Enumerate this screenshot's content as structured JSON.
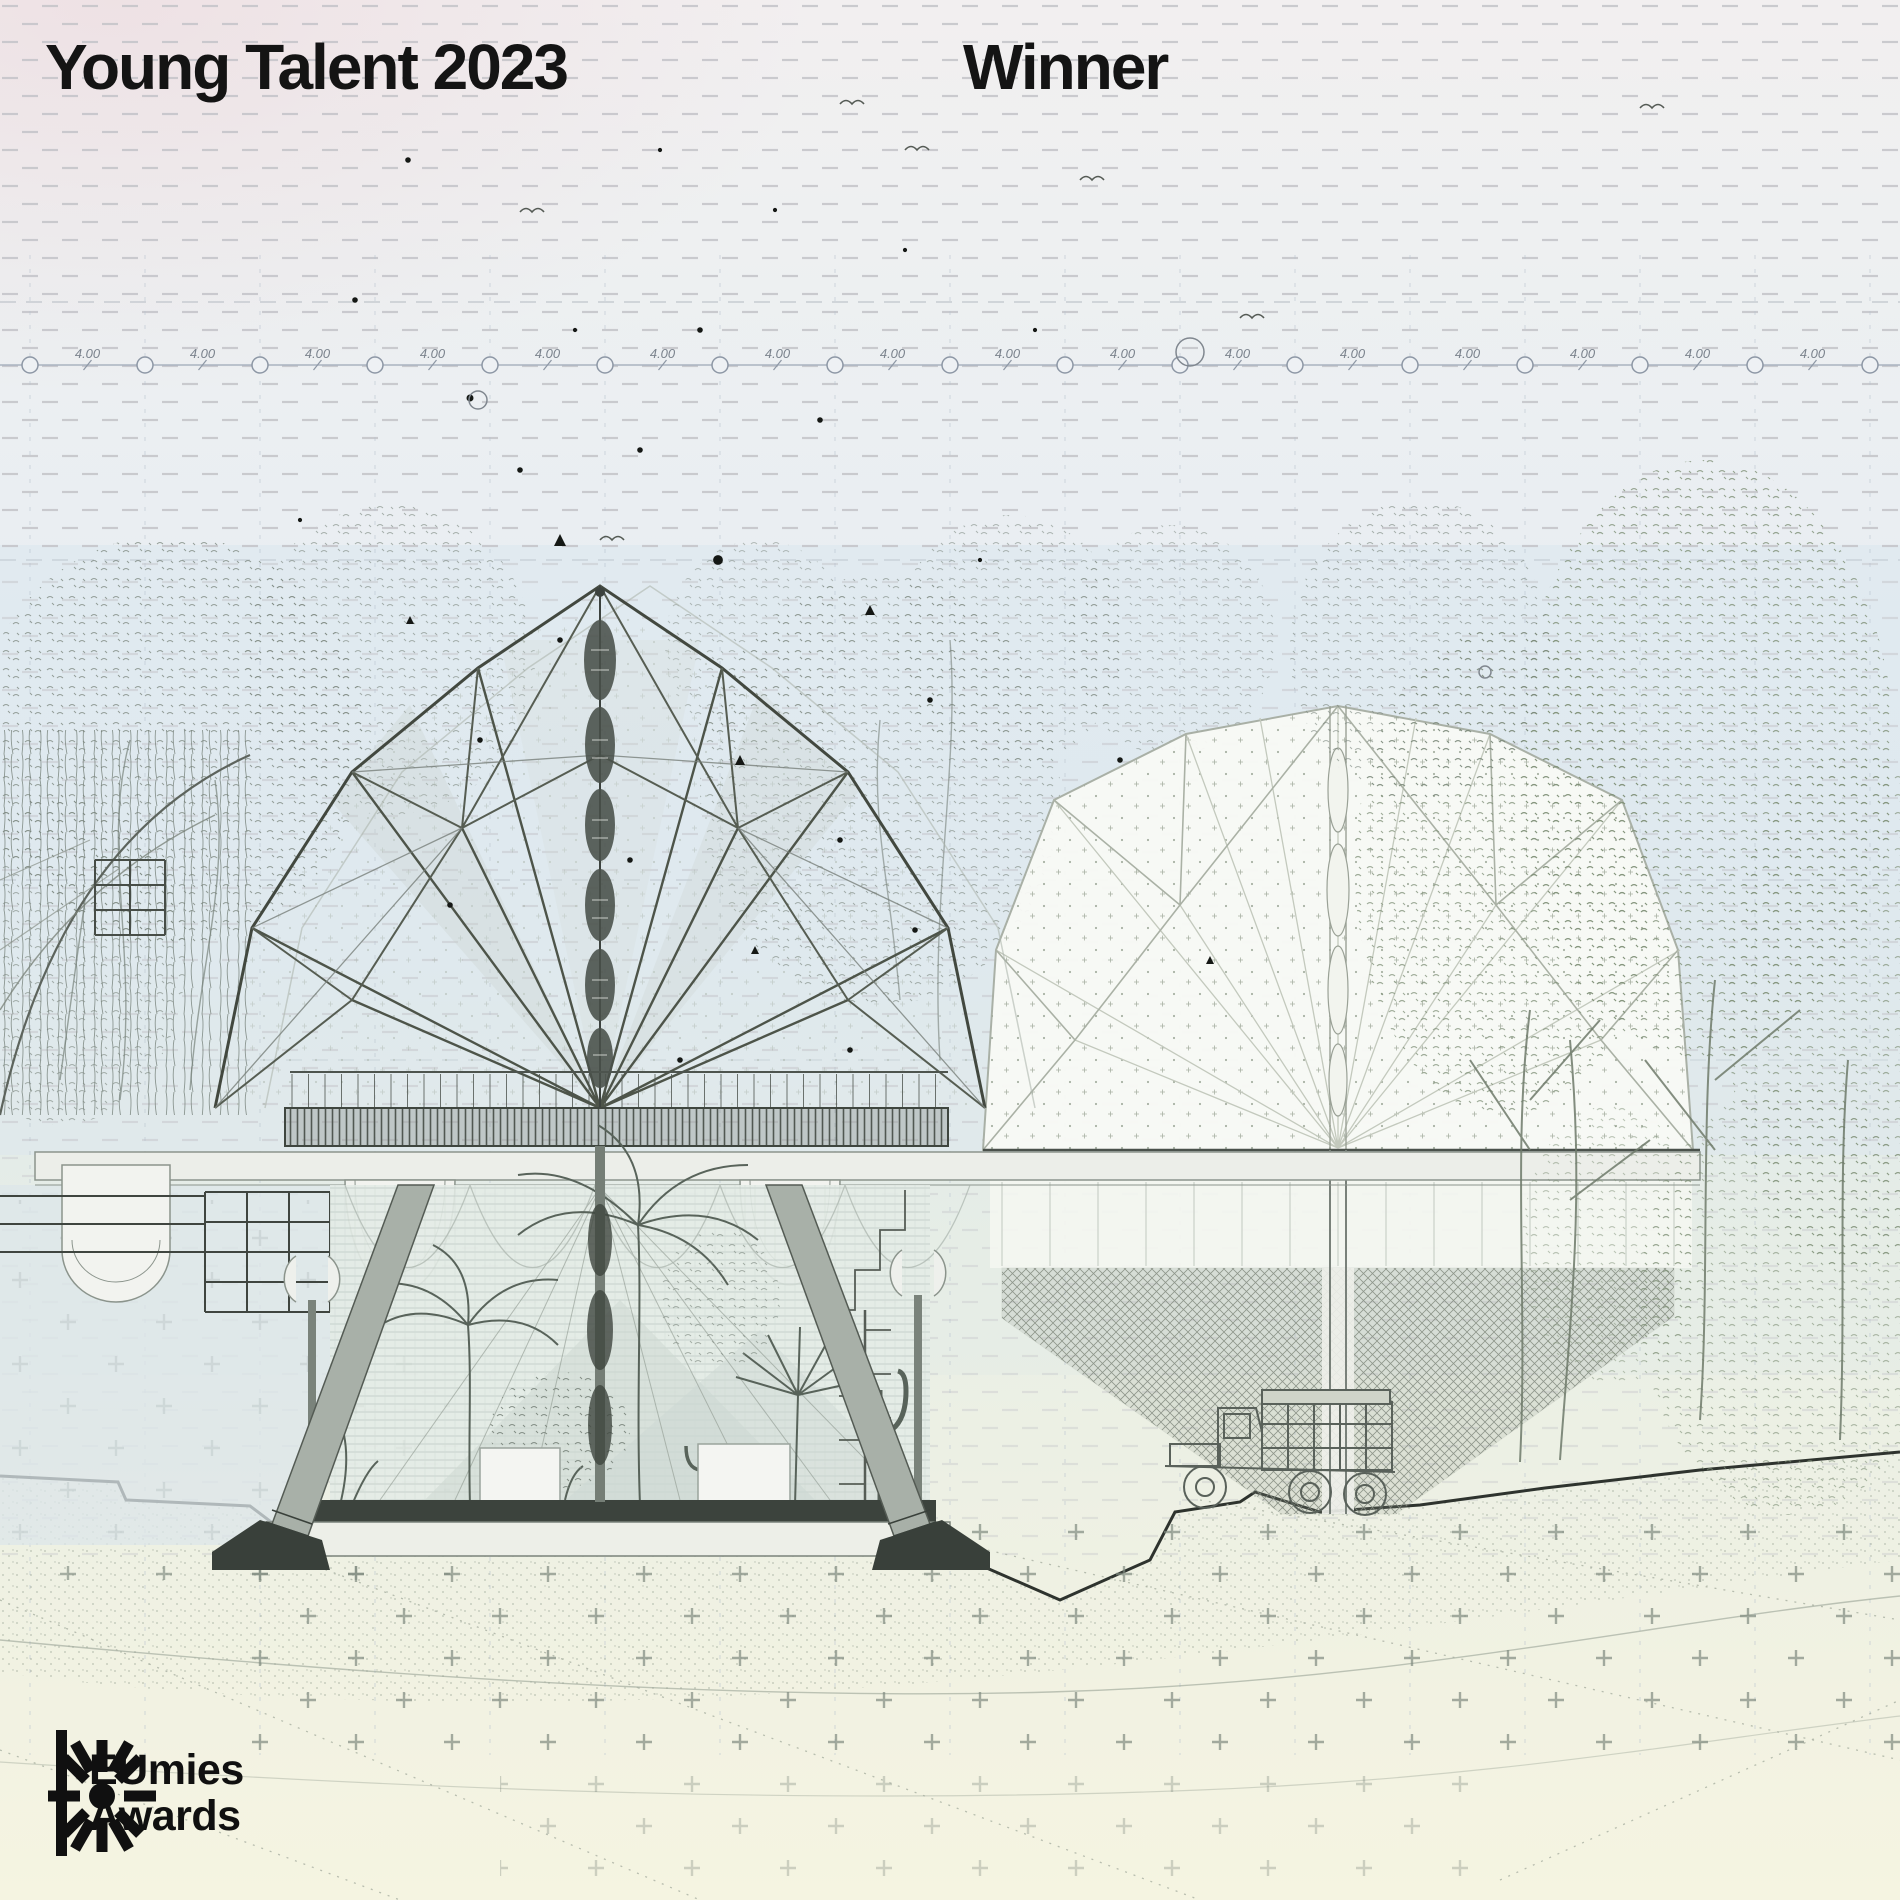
{
  "header": {
    "title": "Young Talent 2023",
    "winner": "Winner"
  },
  "logo": {
    "line1": "EUmies",
    "line2": "Awards",
    "mark": "asterisk-star-icon"
  },
  "drawing": {
    "dimension": {
      "label": "4.00",
      "count": 16,
      "start_x": 30,
      "spacing": 115,
      "y": 365
    },
    "palette": {
      "text": "#141414",
      "ink_dark": "#3f463f",
      "ink_mid": "#6a7168",
      "ink_light": "#aab2a8",
      "sky_blue": "#dbe7ef",
      "sand_cream": "#f4f3e1",
      "leaf_green": "#7f9077"
    }
  }
}
